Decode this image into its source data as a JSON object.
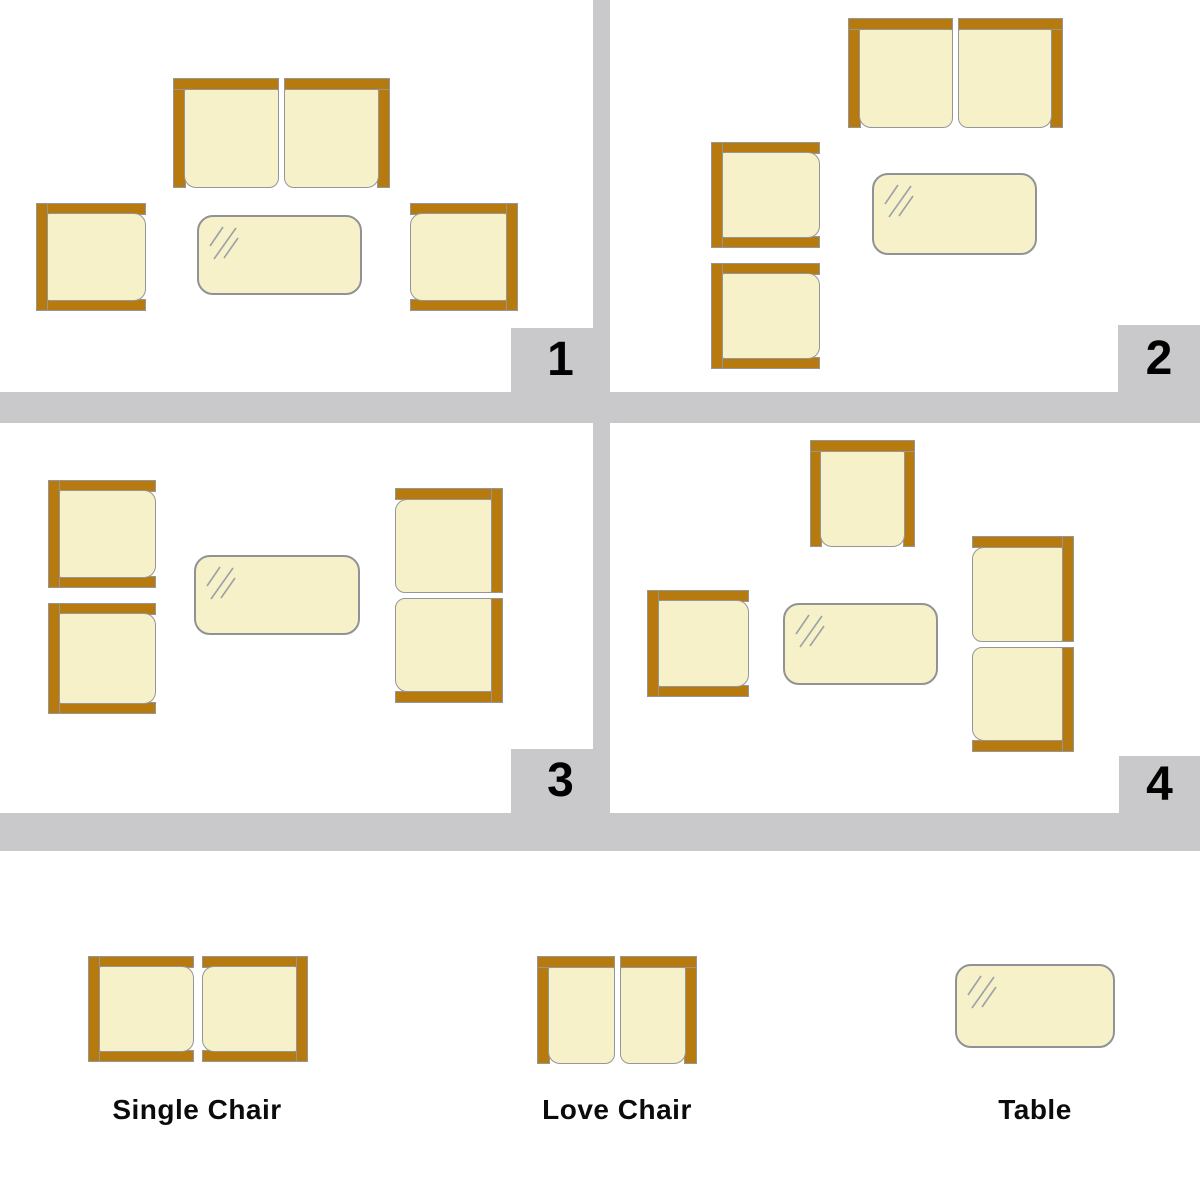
{
  "colors": {
    "frame": "#b77a0f",
    "cushion": "#f6f1c9",
    "outline": "#95969a",
    "table_border": "#909296",
    "shine": "#9ba1a6",
    "grid": "#c9c9cb",
    "number": "#000000",
    "label": "#0b0b0b"
  },
  "quadrants": [
    {
      "number": "1",
      "furniture": [
        {
          "kind": "love-chair",
          "axis": "h",
          "orient": "open-down",
          "x": 173,
          "y": 78,
          "w": 217,
          "h": 110
        },
        {
          "kind": "single-chair",
          "orient": "open-right",
          "x": 36,
          "y": 203,
          "w": 110,
          "h": 108
        },
        {
          "kind": "table",
          "x": 197,
          "y": 215,
          "w": 165,
          "h": 80
        },
        {
          "kind": "single-chair",
          "orient": "open-left",
          "x": 410,
          "y": 203,
          "w": 108,
          "h": 108
        }
      ]
    },
    {
      "number": "2",
      "furniture": [
        {
          "kind": "love-chair",
          "axis": "h",
          "orient": "open-down",
          "x": 848,
          "y": 18,
          "w": 215,
          "h": 110
        },
        {
          "kind": "single-chair",
          "orient": "open-right",
          "x": 711,
          "y": 142,
          "w": 109,
          "h": 106
        },
        {
          "kind": "single-chair",
          "orient": "open-right",
          "x": 711,
          "y": 263,
          "w": 109,
          "h": 106
        },
        {
          "kind": "table",
          "x": 872,
          "y": 173,
          "w": 165,
          "h": 82
        }
      ]
    },
    {
      "number": "3",
      "furniture": [
        {
          "kind": "single-chair",
          "orient": "open-right",
          "x": 48,
          "y": 480,
          "w": 108,
          "h": 108
        },
        {
          "kind": "single-chair",
          "orient": "open-right",
          "x": 48,
          "y": 603,
          "w": 108,
          "h": 111
        },
        {
          "kind": "table",
          "x": 194,
          "y": 555,
          "w": 166,
          "h": 80
        },
        {
          "kind": "love-chair",
          "axis": "v",
          "orient": "open-left",
          "x": 395,
          "y": 488,
          "w": 108,
          "h": 215
        }
      ]
    },
    {
      "number": "4",
      "furniture": [
        {
          "kind": "single-chair",
          "orient": "open-down",
          "x": 810,
          "y": 440,
          "w": 105,
          "h": 107
        },
        {
          "kind": "single-chair",
          "orient": "open-right",
          "x": 647,
          "y": 590,
          "w": 102,
          "h": 107
        },
        {
          "kind": "table",
          "x": 783,
          "y": 603,
          "w": 155,
          "h": 82
        },
        {
          "kind": "love-chair",
          "axis": "v",
          "orient": "open-left",
          "x": 972,
          "y": 536,
          "w": 102,
          "h": 216
        }
      ]
    }
  ],
  "legend": {
    "items": [
      {
        "label": "Single Chair",
        "furniture": [
          {
            "kind": "single-chair",
            "orient": "open-right",
            "x": 88,
            "y": 956,
            "w": 106,
            "h": 106
          },
          {
            "kind": "single-chair",
            "orient": "open-left",
            "x": 202,
            "y": 956,
            "w": 106,
            "h": 106
          }
        ]
      },
      {
        "label": "Love Chair",
        "furniture": [
          {
            "kind": "love-chair",
            "axis": "h",
            "orient": "open-down",
            "x": 537,
            "y": 956,
            "w": 160,
            "h": 108
          }
        ]
      },
      {
        "label": "Table",
        "furniture": [
          {
            "kind": "table",
            "x": 955,
            "y": 964,
            "w": 160,
            "h": 84
          }
        ]
      }
    ]
  }
}
